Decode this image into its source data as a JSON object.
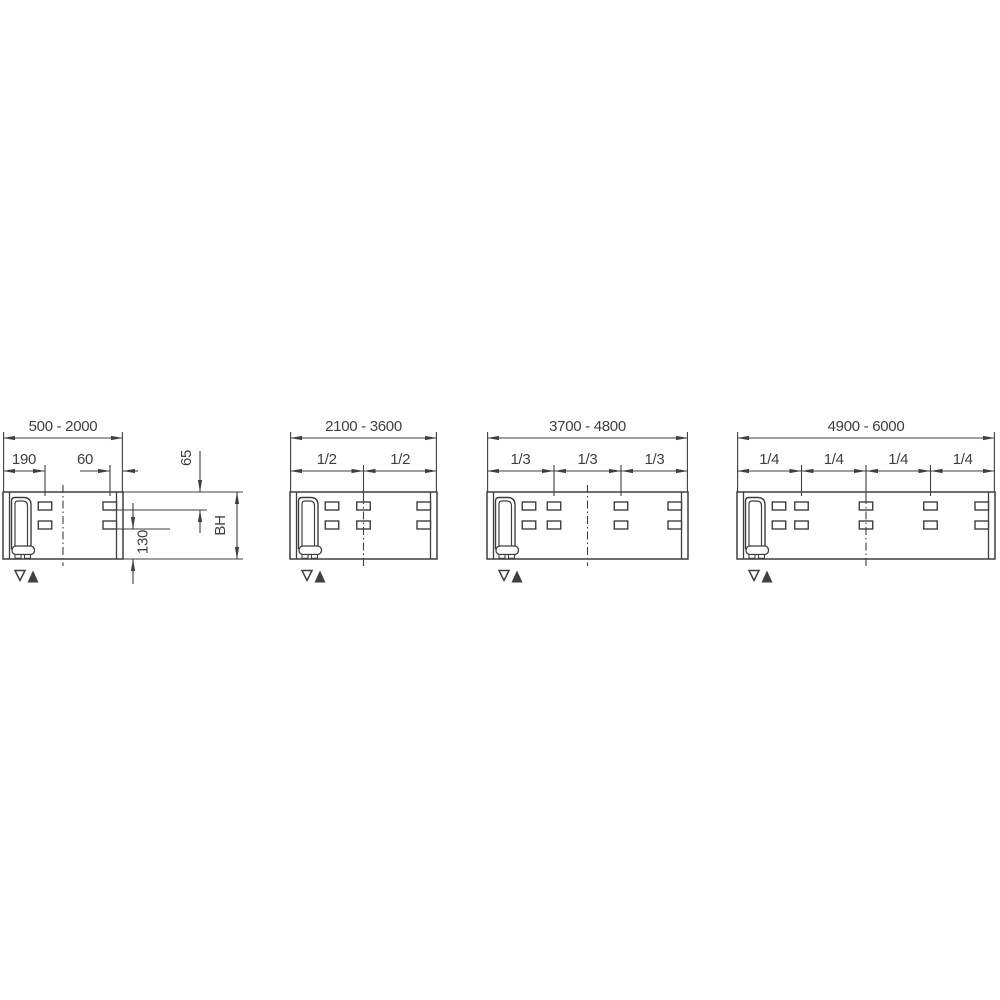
{
  "drawing": {
    "background_color": "#ffffff",
    "line_color": "#3f3f3f",
    "text_color": "#3f3f3f",
    "diagrams": [
      {
        "name": "panel-width-500-2000",
        "range_label": "500 - 2000",
        "fraction_labels": [],
        "sub_dimensions": [
          {
            "label": "190",
            "from": "left-edge",
            "to": "left-slot-column"
          },
          {
            "label": "60",
            "from": "right-slot-column",
            "to": "right-edge"
          }
        ],
        "vertical_dimensions": [
          {
            "label": "65",
            "from": "panel-top",
            "to": "upper-slot-row"
          },
          {
            "label": "130",
            "from": "lower-slot-row",
            "to": "panel-bottom"
          },
          {
            "label": "BH",
            "from": "panel-top",
            "to": "panel-bottom"
          }
        ],
        "markers": [
          {
            "glyph": "▽",
            "name": "open-down-triangle"
          },
          {
            "glyph": "▲",
            "name": "filled-up-triangle"
          }
        ]
      },
      {
        "name": "panel-width-2100-3600",
        "range_label": "2100 - 3600",
        "fraction_labels": [
          "1/2",
          "1/2"
        ],
        "sub_dimensions": [],
        "vertical_dimensions": [],
        "markers": [
          {
            "glyph": "▽",
            "name": "open-down-triangle"
          },
          {
            "glyph": "▲",
            "name": "filled-up-triangle"
          }
        ]
      },
      {
        "name": "panel-width-3700-4800",
        "range_label": "3700 - 4800",
        "fraction_labels": [
          "1/3",
          "1/3",
          "1/3"
        ],
        "sub_dimensions": [],
        "vertical_dimensions": [],
        "markers": [
          {
            "glyph": "▽",
            "name": "open-down-triangle"
          },
          {
            "glyph": "▲",
            "name": "filled-up-triangle"
          }
        ]
      },
      {
        "name": "panel-width-4900-6000",
        "range_label": "4900 - 6000",
        "fraction_labels": [
          "1/4",
          "1/4",
          "1/4",
          "1/4"
        ],
        "sub_dimensions": [],
        "vertical_dimensions": [],
        "markers": [
          {
            "glyph": "▽",
            "name": "open-down-triangle"
          },
          {
            "glyph": "▲",
            "name": "filled-up-triangle"
          }
        ]
      }
    ]
  }
}
